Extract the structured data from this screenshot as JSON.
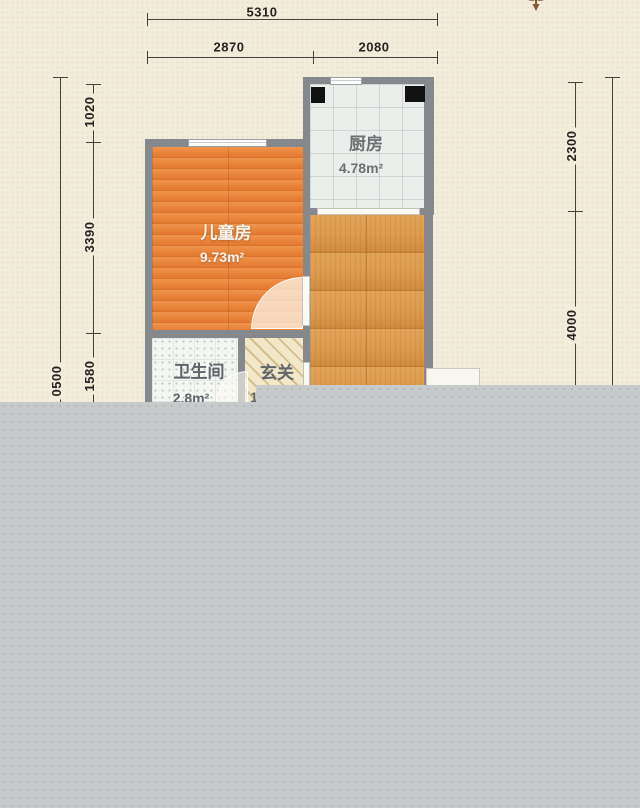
{
  "plan": {
    "dims_top": {
      "total": "5310",
      "left_segment": "2870",
      "right_segment": "2080"
    },
    "dims_left": {
      "outer_partial": "0500",
      "seg1": "1020",
      "seg2": "3390",
      "seg3": "1580"
    },
    "dims_right": {
      "seg1": "2300",
      "seg2": "4000"
    },
    "rooms": {
      "kitchen": {
        "name": "厨房",
        "area": "4.78m²"
      },
      "kids_room": {
        "name": "儿童房",
        "area": "9.73m²"
      },
      "bathroom": {
        "name": "卫生间",
        "area": "2.8m²"
      },
      "entry": {
        "name": "玄关",
        "area_fragment": "1"
      }
    },
    "colors": {
      "background": "#f2ecdb",
      "wall": "#85888c",
      "kids_floor": "#ea863c",
      "corridor_floor": "#dd9c4e",
      "kitchen_floor": "#eceeeb",
      "bathroom_floor": "#f4f6f2",
      "entry_floor": "#f2e7c9",
      "overlay_gray": "#c6cacb",
      "dimension_line": "#45423c",
      "ornament_brown": "#7b4a27"
    }
  }
}
